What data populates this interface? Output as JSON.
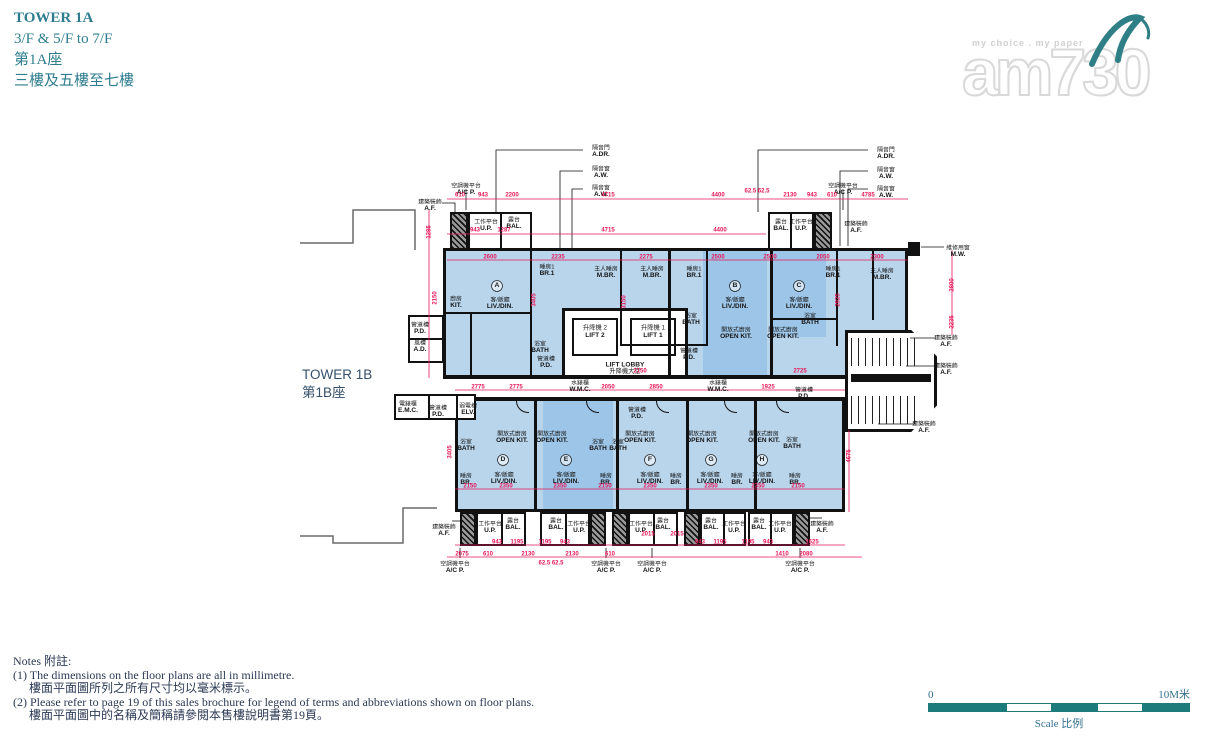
{
  "header": {
    "title_en": "TOWER 1A",
    "floors_en": "3/F & 5/F to 7/F",
    "title_zh": "第1A座",
    "floors_zh": "三樓及五樓至七樓"
  },
  "logo": {
    "brand": "am730",
    "tagline": "my choice . my paper"
  },
  "adjacent_tower": {
    "en": "TOWER 1B",
    "zh": "第1B座"
  },
  "colors": {
    "dimension": "#e6195a",
    "accent_teal": "#2e7d8f",
    "scale_teal": "#1d7c7b",
    "room_blue": "#b9d5ec",
    "room_blue_dark": "#9dc5e7"
  },
  "plan": {
    "core": {
      "lift2_zh": "升降機 2",
      "lift2_en": "LIFT 2",
      "lift1_zh": "升降機 1",
      "lift1_en": "LIFT 1",
      "lobby_en": "LIFT LOBBY",
      "lobby_zh": "升降機大堂"
    },
    "flats": [
      {
        "letter": "A",
        "x": 497,
        "y": 286
      },
      {
        "letter": "B",
        "x": 735,
        "y": 286
      },
      {
        "letter": "C",
        "x": 799,
        "y": 286
      },
      {
        "letter": "D",
        "x": 503,
        "y": 460
      },
      {
        "letter": "E",
        "x": 566,
        "y": 460
      },
      {
        "letter": "F",
        "x": 650,
        "y": 460
      },
      {
        "letter": "G",
        "x": 711,
        "y": 460
      },
      {
        "letter": "H",
        "x": 762,
        "y": 460
      }
    ],
    "rooms": [
      {
        "zh": "廚房",
        "en": "KIT.",
        "x": 456,
        "y": 296
      },
      {
        "zh": "客/飯廳",
        "en": "LIV./DIN.",
        "x": 500,
        "y": 297
      },
      {
        "zh": "睡房1",
        "en": "BR.1",
        "x": 547,
        "y": 264
      },
      {
        "zh": "主人睡房",
        "en": "M.BR.",
        "x": 606,
        "y": 266
      },
      {
        "zh": "浴室",
        "en": "BATH",
        "x": 540,
        "y": 341
      },
      {
        "zh": "管道槽",
        "en": "P.D.",
        "x": 546,
        "y": 356
      },
      {
        "zh": "主人睡房",
        "en": "M.BR.",
        "x": 652,
        "y": 266
      },
      {
        "zh": "睡房1",
        "en": "BR.1",
        "x": 694,
        "y": 266
      },
      {
        "zh": "浴室",
        "en": "BATH",
        "x": 691,
        "y": 313
      },
      {
        "zh": "客/飯廳",
        "en": "LIV./DIN.",
        "x": 735,
        "y": 297
      },
      {
        "zh": "開放式廚房",
        "en": "OPEN KIT.",
        "x": 736,
        "y": 327
      },
      {
        "zh": "管道槽",
        "en": "P.D.",
        "x": 689,
        "y": 348
      },
      {
        "zh": "客/飯廳",
        "en": "LIV./DIN.",
        "x": 799,
        "y": 297
      },
      {
        "zh": "開放式廚房",
        "en": "OPEN KIT.",
        "x": 783,
        "y": 327
      },
      {
        "zh": "浴室",
        "en": "BATH",
        "x": 810,
        "y": 313
      },
      {
        "zh": "睡房1",
        "en": "BR.1",
        "x": 833,
        "y": 266
      },
      {
        "zh": "主人睡房",
        "en": "M.BR.",
        "x": 882,
        "y": 268
      },
      {
        "zh": "水錶櫃",
        "en": "W.M.C.",
        "x": 580,
        "y": 380
      },
      {
        "zh": "水錶櫃",
        "en": "W.M.C.",
        "x": 718,
        "y": 380
      },
      {
        "zh": "管道槽",
        "en": "P.D.",
        "x": 804,
        "y": 387
      },
      {
        "zh": "管道槽",
        "en": "P.D.",
        "x": 420,
        "y": 322
      },
      {
        "zh": "風槽",
        "en": "A.D.",
        "x": 420,
        "y": 340
      },
      {
        "zh": "電錶櫃",
        "en": "E.M.C.",
        "x": 408,
        "y": 401
      },
      {
        "zh": "管道槽",
        "en": "P.D.",
        "x": 438,
        "y": 405
      },
      {
        "zh": "弱電槽",
        "en": "ELV.",
        "x": 468,
        "y": 403
      },
      {
        "zh": "管道槽",
        "en": "P.D.",
        "x": 637,
        "y": 407
      },
      {
        "zh": "浴室",
        "en": "BATH",
        "x": 466,
        "y": 439
      },
      {
        "zh": "開放式廚房",
        "en": "OPEN KIT.",
        "x": 512,
        "y": 431
      },
      {
        "zh": "睡房",
        "en": "BR.",
        "x": 466,
        "y": 473
      },
      {
        "zh": "客/飯廳",
        "en": "LIV./DIN.",
        "x": 504,
        "y": 472
      },
      {
        "zh": "開放式廚房",
        "en": "OPEN KIT.",
        "x": 552,
        "y": 431
      },
      {
        "zh": "浴室",
        "en": "BATH",
        "x": 598,
        "y": 439
      },
      {
        "zh": "客/飯廳",
        "en": "LIV./DIN.",
        "x": 566,
        "y": 472
      },
      {
        "zh": "睡房",
        "en": "BR.",
        "x": 606,
        "y": 473
      },
      {
        "zh": "開放式廚房",
        "en": "OPEN KIT.",
        "x": 640,
        "y": 431
      },
      {
        "zh": "浴室",
        "en": "BATH",
        "x": 618,
        "y": 439
      },
      {
        "zh": "客/飯廳",
        "en": "LIV./DIN.",
        "x": 650,
        "y": 472
      },
      {
        "zh": "睡房",
        "en": "BR.",
        "x": 676,
        "y": 473
      },
      {
        "zh": "開放式廚房",
        "en": "OPEN KIT.",
        "x": 702,
        "y": 431
      },
      {
        "zh": "客/飯廳",
        "en": "LIV./DIN.",
        "x": 710,
        "y": 472
      },
      {
        "zh": "睡房",
        "en": "BR.",
        "x": 737,
        "y": 473
      },
      {
        "zh": "開放式廚房",
        "en": "OPEN KIT.",
        "x": 764,
        "y": 431
      },
      {
        "zh": "浴室",
        "en": "BATH",
        "x": 792,
        "y": 437
      },
      {
        "zh": "客/飯廳",
        "en": "LIV./DIN.",
        "x": 762,
        "y": 472
      },
      {
        "zh": "睡房",
        "en": "BR.",
        "x": 795,
        "y": 473
      },
      {
        "zh": "工作平台",
        "en": "U.P.",
        "x": 486,
        "y": 219
      },
      {
        "zh": "露台",
        "en": "BAL.",
        "x": 514,
        "y": 217
      },
      {
        "zh": "露台",
        "en": "BAL.",
        "x": 781,
        "y": 219
      },
      {
        "zh": "工作平台",
        "en": "U.P.",
        "x": 801,
        "y": 219
      },
      {
        "zh": "工作平台",
        "en": "U.P.",
        "x": 490,
        "y": 521
      },
      {
        "zh": "露台",
        "en": "BAL.",
        "x": 513,
        "y": 518
      },
      {
        "zh": "露台",
        "en": "BAL.",
        "x": 556,
        "y": 518
      },
      {
        "zh": "工作平台",
        "en": "U.P.",
        "x": 579,
        "y": 521
      },
      {
        "zh": "工作平台",
        "en": "U.P.",
        "x": 641,
        "y": 521
      },
      {
        "zh": "露台",
        "en": "BAL.",
        "x": 663,
        "y": 518
      },
      {
        "zh": "露台",
        "en": "BAL.",
        "x": 711,
        "y": 518
      },
      {
        "zh": "工作平台",
        "en": "U.P.",
        "x": 734,
        "y": 521
      },
      {
        "zh": "露台",
        "en": "BAL.",
        "x": 759,
        "y": 518
      },
      {
        "zh": "工作平台",
        "en": "U.P.",
        "x": 780,
        "y": 521
      }
    ],
    "callouts": [
      {
        "zh": "空調機平台",
        "en": "A/C P.",
        "x": 466,
        "y": 183
      },
      {
        "zh": "建築裝飾",
        "en": "A.F.",
        "x": 430,
        "y": 199
      },
      {
        "zh": "隔音門",
        "en": "A.DR.",
        "x": 601,
        "y": 145
      },
      {
        "zh": "隔音窗",
        "en": "A.W.",
        "x": 601,
        "y": 166
      },
      {
        "zh": "隔音窗",
        "en": "A.W.",
        "x": 601,
        "y": 185
      },
      {
        "zh": "隔音門",
        "en": "A.DR.",
        "x": 886,
        "y": 147
      },
      {
        "zh": "隔音窗",
        "en": "A.W.",
        "x": 886,
        "y": 167
      },
      {
        "zh": "隔音窗",
        "en": "A.W.",
        "x": 886,
        "y": 186
      },
      {
        "zh": "空調機平台",
        "en": "A/C P.",
        "x": 843,
        "y": 183
      },
      {
        "zh": "建築裝飾",
        "en": "A.F.",
        "x": 856,
        "y": 221
      },
      {
        "zh": "維修用窗",
        "en": "M.W.",
        "x": 958,
        "y": 245
      },
      {
        "zh": "建築裝飾",
        "en": "A.F.",
        "x": 946,
        "y": 335
      },
      {
        "zh": "建築裝飾",
        "en": "A.F.",
        "x": 946,
        "y": 363
      },
      {
        "zh": "建築裝飾",
        "en": "A.F.",
        "x": 924,
        "y": 421
      },
      {
        "zh": "建築裝飾",
        "en": "A.F.",
        "x": 444,
        "y": 524
      },
      {
        "zh": "建築裝飾",
        "en": "A.F.",
        "x": 822,
        "y": 521
      },
      {
        "zh": "空調機平台",
        "en": "A/C P.",
        "x": 455,
        "y": 561
      },
      {
        "zh": "空調機平台",
        "en": "A/C P.",
        "x": 606,
        "y": 561
      },
      {
        "zh": "空調機平台",
        "en": "A/C P.",
        "x": 652,
        "y": 561
      },
      {
        "zh": "空調機平台",
        "en": "A/C P.",
        "x": 800,
        "y": 561
      }
    ],
    "dims_h": [
      [
        "610",
        460,
        195
      ],
      [
        "943",
        483,
        195
      ],
      [
        "2200",
        512,
        195
      ],
      [
        "4715",
        608,
        195
      ],
      [
        "4400",
        718,
        195
      ],
      [
        "2130",
        790,
        195
      ],
      [
        "943",
        812,
        195
      ],
      [
        "610",
        832,
        195
      ],
      [
        "4785",
        868,
        195
      ],
      [
        "943",
        475,
        230
      ],
      [
        "1287",
        504,
        230
      ],
      [
        "4715",
        608,
        230
      ],
      [
        "4400",
        720,
        230
      ],
      [
        "62.5 62.5",
        757,
        191
      ],
      [
        "2600",
        490,
        257
      ],
      [
        "2235",
        558,
        257
      ],
      [
        "2275",
        646,
        257
      ],
      [
        "2500",
        718,
        257
      ],
      [
        "2500",
        770,
        257
      ],
      [
        "2050",
        823,
        257
      ],
      [
        "2300",
        877,
        257
      ],
      [
        "2150",
        640,
        371
      ],
      [
        "2725",
        800,
        371
      ],
      [
        "2775",
        478,
        387
      ],
      [
        "2775",
        516,
        387
      ],
      [
        "2050",
        608,
        387
      ],
      [
        "2850",
        656,
        387
      ],
      [
        "1925",
        768,
        387
      ],
      [
        "2150",
        470,
        486
      ],
      [
        "2350",
        506,
        486
      ],
      [
        "2350",
        560,
        486
      ],
      [
        "2150",
        605,
        486
      ],
      [
        "2350",
        650,
        486
      ],
      [
        "2350",
        711,
        486
      ],
      [
        "2350",
        758,
        486
      ],
      [
        "2150",
        798,
        486
      ],
      [
        "943",
        497,
        542
      ],
      [
        "1195",
        517,
        542
      ],
      [
        "1195",
        545,
        542
      ],
      [
        "943",
        565,
        542
      ],
      [
        "943",
        700,
        542
      ],
      [
        "1195",
        720,
        542
      ],
      [
        "1195",
        748,
        542
      ],
      [
        "943",
        768,
        542
      ],
      [
        "1625",
        812,
        542
      ],
      [
        "2075",
        462,
        554
      ],
      [
        "610",
        488,
        554
      ],
      [
        "2130",
        528,
        554
      ],
      [
        "2130",
        572,
        554
      ],
      [
        "610",
        610,
        554
      ],
      [
        "1410",
        782,
        554
      ],
      [
        "2080",
        806,
        554
      ],
      [
        "62.5 62.5",
        551,
        563
      ],
      [
        "2015",
        648,
        534
      ],
      [
        "2015",
        677,
        534
      ]
    ],
    "dims_v": [
      [
        "1285",
        429,
        232
      ],
      [
        "2150",
        435,
        298
      ],
      [
        "3405",
        450,
        452
      ],
      [
        "2800",
        952,
        285
      ],
      [
        "2235",
        952,
        322
      ],
      [
        "4675",
        849,
        456
      ],
      [
        "3405",
        534,
        300
      ],
      [
        "3150",
        624,
        302
      ],
      [
        "2925",
        838,
        300
      ]
    ]
  },
  "notes": {
    "heading": "Notes 附註:",
    "lines": [
      "(1) The dimensions on the floor plans are all in millimetre.",
      "樓面平面圖所列之所有尺寸均以毫米標示。",
      "(2) Please refer to page 19 of this sales brochure for legend of terms and abbreviations shown on floor plans.",
      "樓面平面圖中的名稱及簡稱請參閱本售樓說明書第19頁。"
    ]
  },
  "scale_bar": {
    "start": "0",
    "end": "10M米",
    "label": "Scale 比例"
  }
}
